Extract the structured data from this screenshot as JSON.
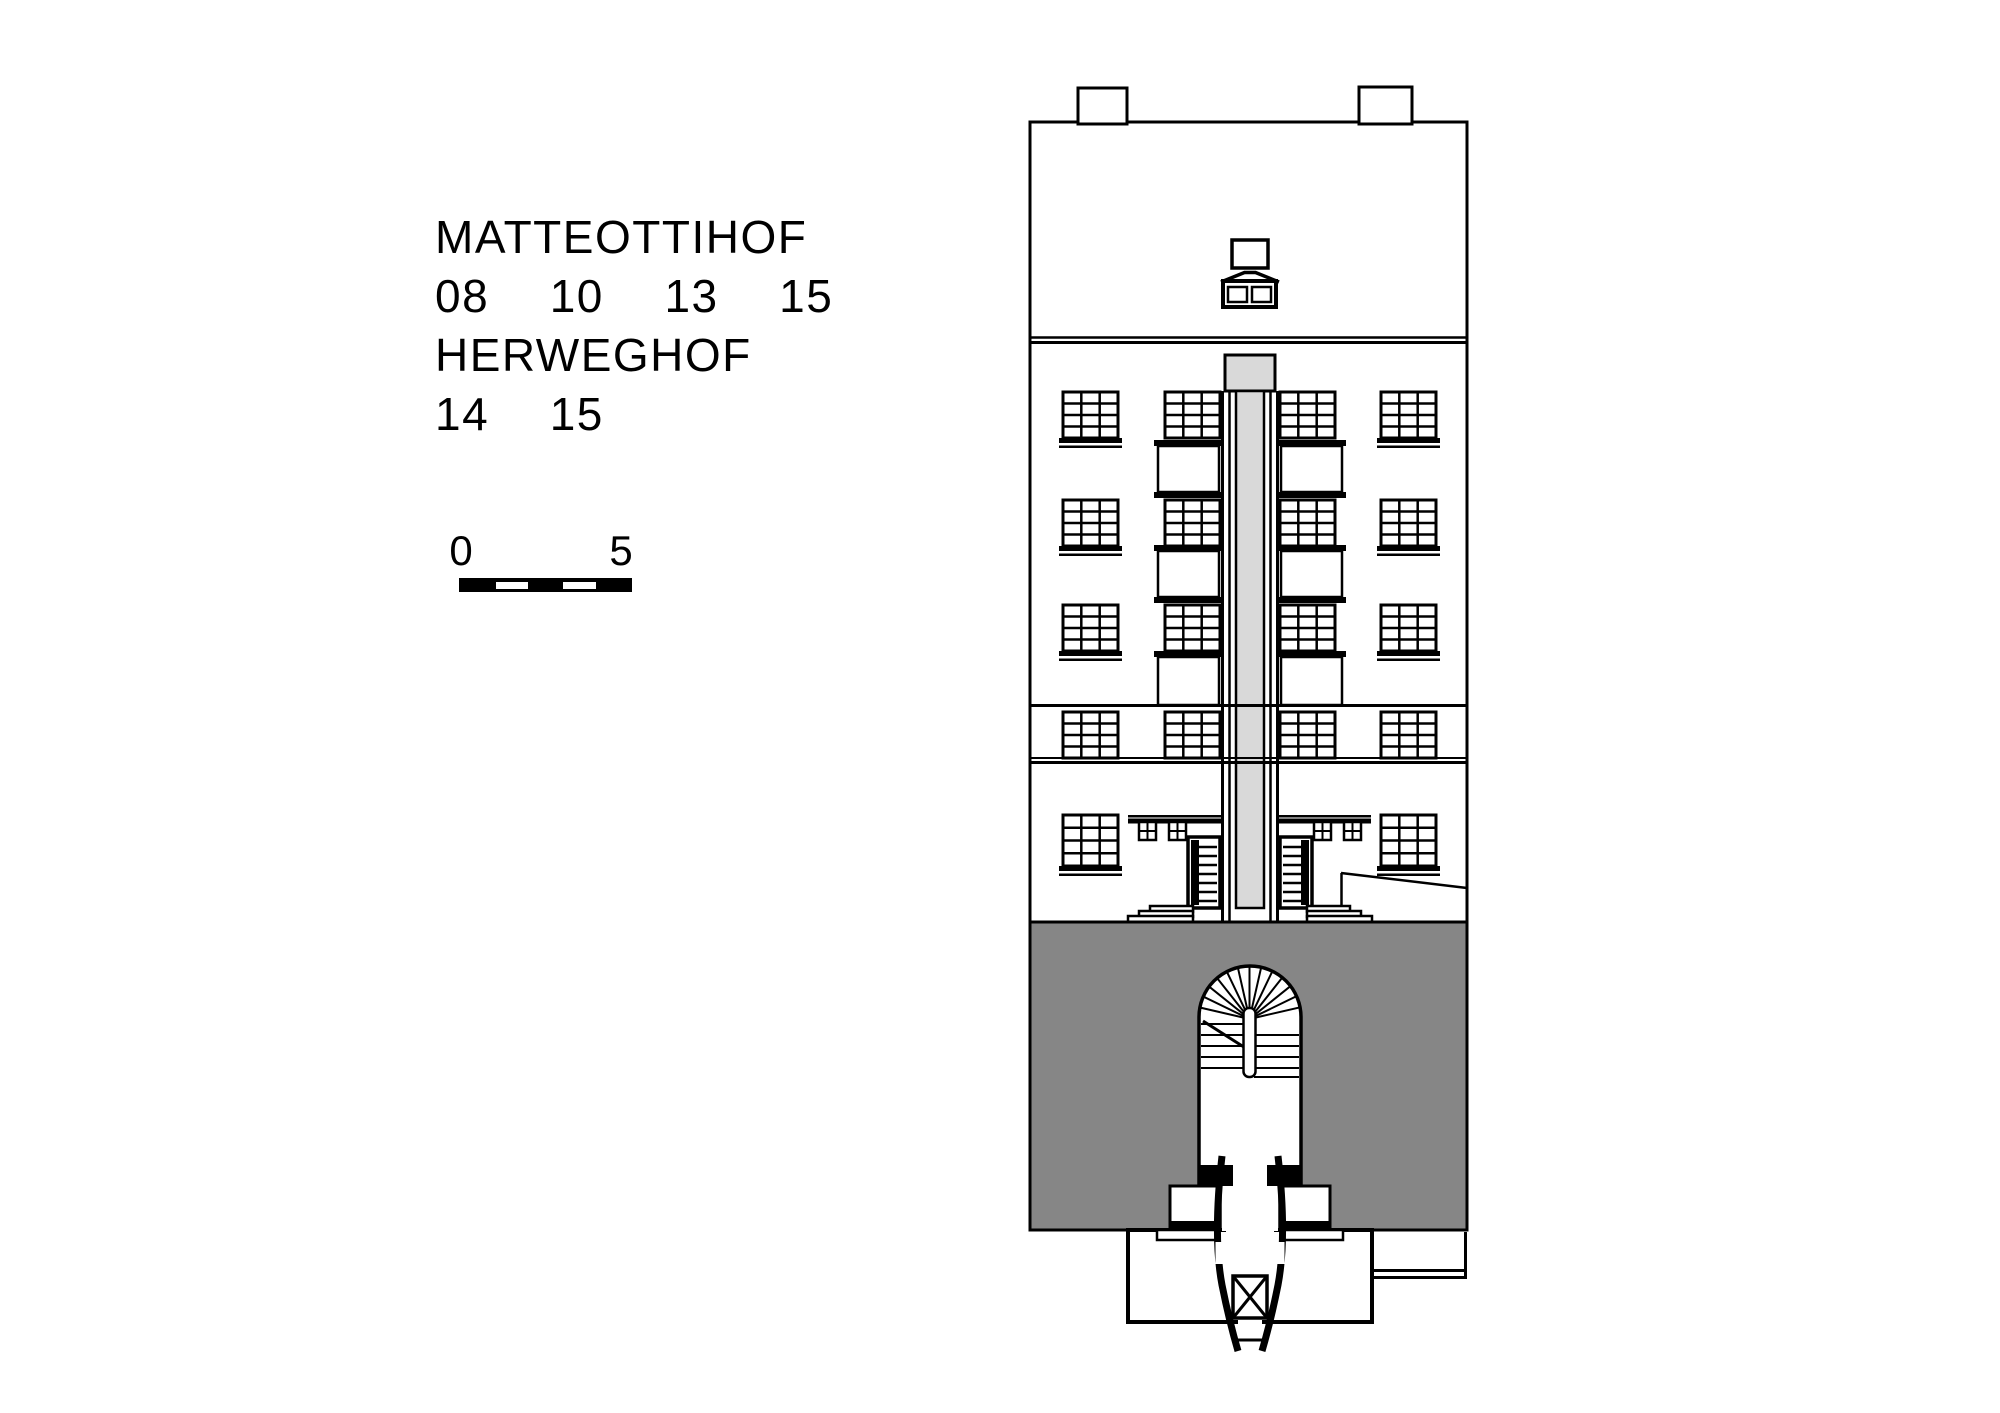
{
  "title_block": {
    "line1": "MATTEOTTIHOF",
    "line2": "08  10  13  15",
    "line3": "HERWEGHOF",
    "line4": "14  15"
  },
  "scale_bar": {
    "label_start": "0",
    "label_end": "5"
  },
  "colors": {
    "line": "#000000",
    "background": "#ffffff",
    "courtyard_fill": "#868686",
    "stair_shaft_fill": "#d9d9d9"
  }
}
